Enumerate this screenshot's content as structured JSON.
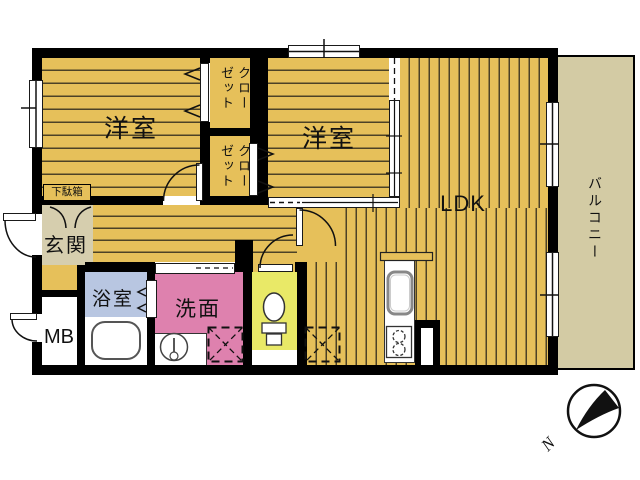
{
  "floorplan": {
    "labels": {
      "bedroom1": "洋室",
      "bedroom2": "洋室",
      "closet1": "クローゼット",
      "closet2": "クローゼット",
      "ldk": "LDK",
      "balcony": "バルコニー",
      "entrance": "玄関",
      "shoe_cabinet": "下駄箱",
      "bath": "浴室",
      "washroom": "洗面",
      "meter_box": "MB"
    },
    "compass": {
      "north": "N"
    },
    "colors": {
      "wood_floor": "#e6c05a",
      "floor_line": "#4c4226",
      "balcony": "#d3cba4",
      "entrance": "#d6ceae",
      "bath": "#b8c6e1",
      "washroom": "#de81ae",
      "toilet": "#e9e967",
      "wall": "#000000"
    }
  }
}
